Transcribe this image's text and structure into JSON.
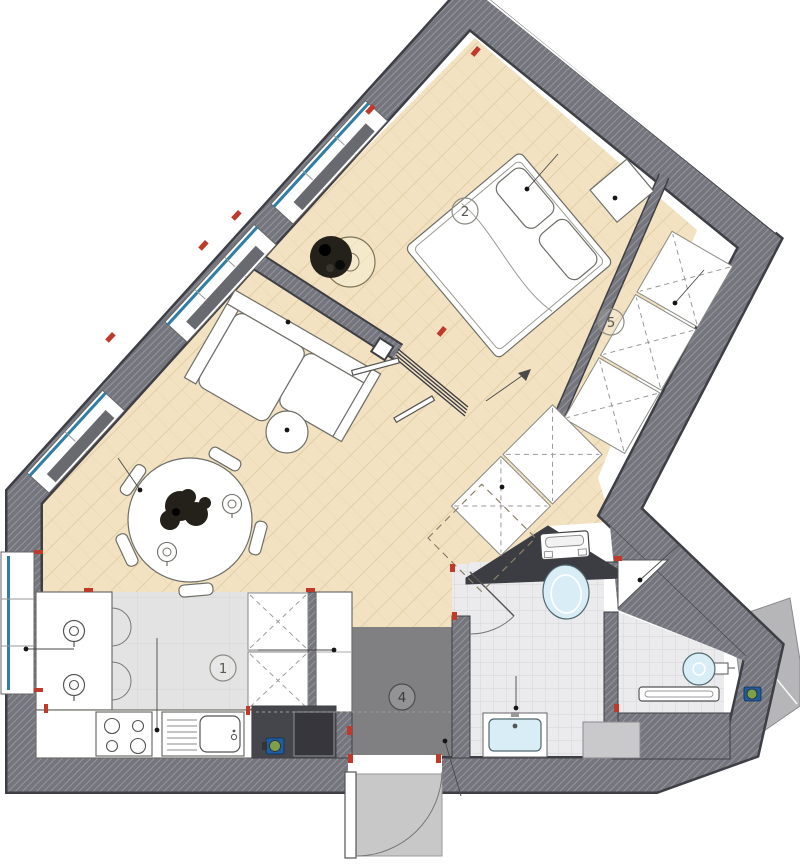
{
  "rooms": [
    {
      "num": "1",
      "name": "kitchen"
    },
    {
      "num": "2",
      "name": "bedroom"
    },
    {
      "num": "4",
      "name": "hallway"
    },
    {
      "num": "5",
      "name": "wardrobe"
    }
  ],
  "colors": {
    "wall_fill": "#75757d",
    "wall_hatch": "#9b9ba3",
    "wall_edge": "#3e3e45",
    "pocket": "#3c3c43",
    "wood": "#f2e2c2",
    "wood_line": "#e3cfa6",
    "kitchen_floor": "#e3e3e3",
    "kitchen_line": "#d5d5d5",
    "hall_floor": "#808083",
    "bath_floor": "#ebebed",
    "tile_line": "#d4d4d8",
    "furn_fill": "#ffffff",
    "furn_edge": "#6e6e68",
    "fixture_blue": "#d9edf6",
    "fixture_edge": "#50676f",
    "glazing": "#2f7ea6",
    "radiator": "#696970",
    "accent_red": "#c0392b",
    "valve_blue": "#1e5c9e",
    "valve_green": "#7fa04a",
    "landing": "#c8c8c8",
    "shaft": "#b6b6b9",
    "dark_unit": "#45454c",
    "darker_unit": "#36363c",
    "label_edge": "#8c8c83",
    "label_text": "#5a5a52",
    "leader": "#4a4a4a",
    "dash_line": "#9a9a9a",
    "plant_dark": "#24201a"
  }
}
